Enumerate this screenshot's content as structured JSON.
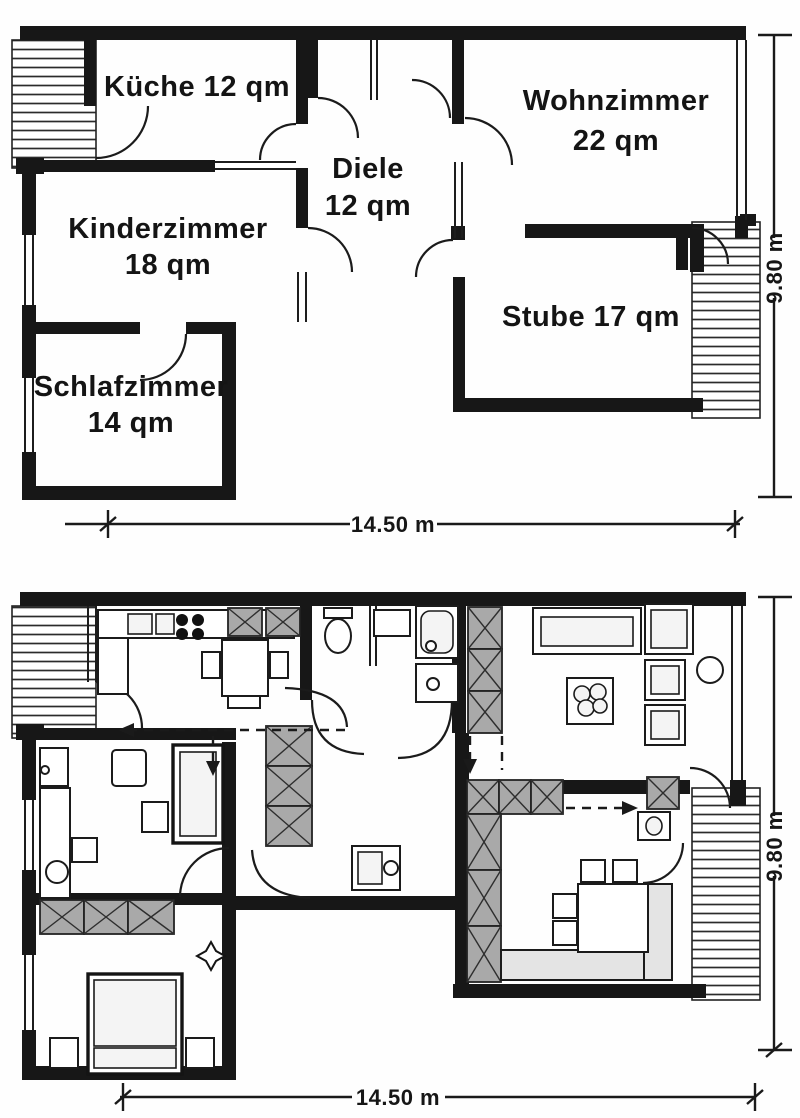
{
  "upper_plan": {
    "rooms": {
      "kueche": {
        "label": "Küche 12 qm"
      },
      "wohnzimmer": {
        "name": "Wohnzimmer",
        "area": "22 qm"
      },
      "diele": {
        "name": "Diele",
        "area": "12 qm"
      },
      "kinderzimmer": {
        "name": "Kinderzimmer",
        "area": "18 qm"
      },
      "stube": {
        "label": "Stube 17 qm"
      },
      "schlafzimmer": {
        "name": "Schlafzimmer",
        "area": "14 qm"
      }
    },
    "dimensions": {
      "width": "14.50 m",
      "height": "9.80 m"
    }
  },
  "lower_plan": {
    "dimensions": {
      "width": "14.50 m",
      "height": "9.80 m"
    }
  },
  "colors": {
    "ink": "#1b1b1b",
    "wardrobe_fill": "#a9a9a9",
    "bench_fill": "#e4e4e4"
  }
}
